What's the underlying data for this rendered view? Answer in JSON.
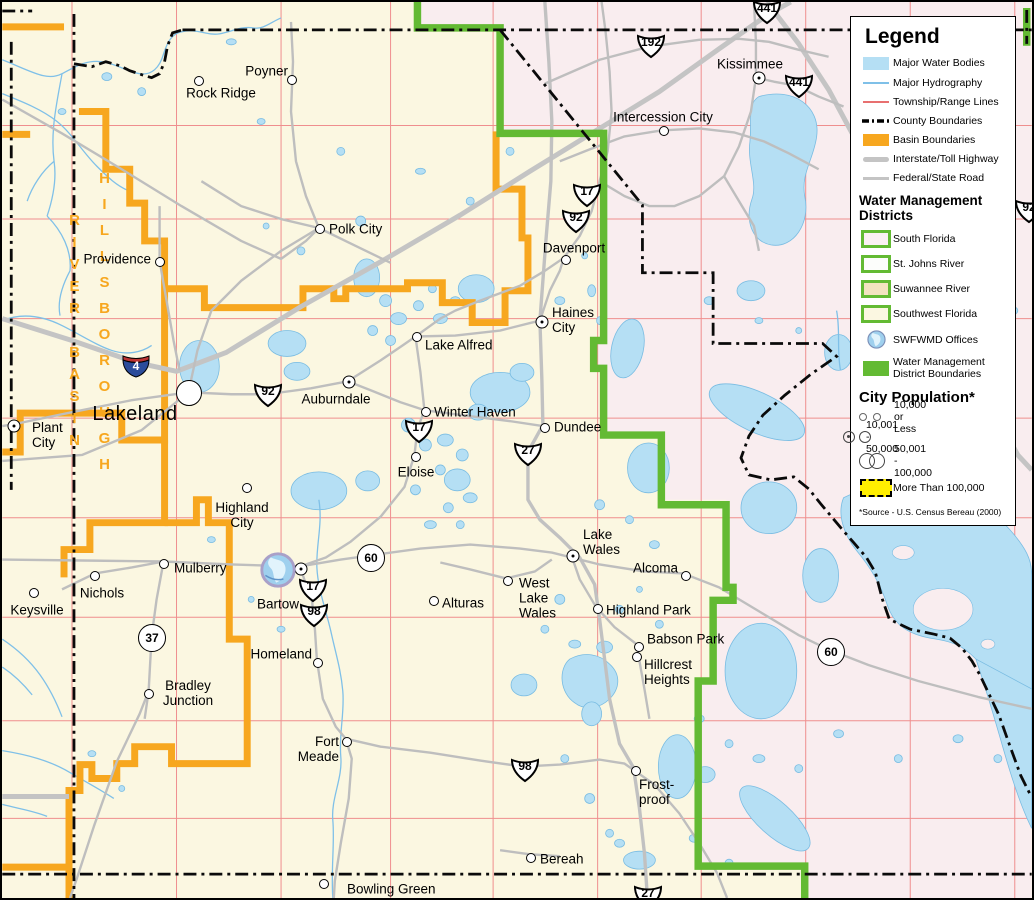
{
  "colors": {
    "background_cream": "#FBF7E1",
    "south_florida_pink": "#F9EDEF",
    "water": "#B5DFF4",
    "hydrography": "#7FC0E8",
    "township_lines": "#EF8E8E",
    "county": "#0A0A0A",
    "basin_orange": "#F7A71F",
    "roads_gray": "#BEBEBE",
    "wmd_green": "#63BA33",
    "lake_label_blue": "#3C6FA5",
    "city_100k_yellow": "#FFEE00"
  },
  "legend": {
    "title": "Legend",
    "items": [
      {
        "label": "Major Water Bodies"
      },
      {
        "label": "Major Hydrography"
      },
      {
        "label": "Township/Range Lines"
      },
      {
        "label": "County Boundaries"
      },
      {
        "label": "Basin Boundaries"
      },
      {
        "label": "Interstate/Toll Highway"
      },
      {
        "label": "Federal/State Road"
      }
    ],
    "wmd_heading": "Water Management\nDistricts",
    "districts": [
      {
        "label": "South Florida",
        "style": "background:#FBF0F3"
      },
      {
        "label": "St. Johns River",
        "style": "background:#FCFDFB"
      },
      {
        "label": "Suwannee River",
        "style": "background:#F3E3C0"
      },
      {
        "label": "Southwest Florida",
        "style": "background:#FBF7E1"
      }
    ],
    "offices_label": "SWFWMD Offices",
    "wmd_boundaries_label": "Water Management\nDistrict Boundaries",
    "pop_heading": "City Population*",
    "pop_items": [
      {
        "label": "10,000 or Less",
        "cls": "pop1"
      },
      {
        "label": "10,001 - 50,000",
        "cls": "pop2"
      },
      {
        "label": "50,001 - 100,000",
        "cls": "pop3"
      }
    ],
    "pop_100k_label": "More Than 100,000",
    "footnote": "*Source - U.S. Census Bereau (2000)"
  },
  "map": {
    "counties": [
      {
        "text": "P O L K",
        "x": 436,
        "y": 524
      },
      {
        "text": "O S C E O L A",
        "x": 845,
        "y": 307
      }
    ],
    "basins": [
      {
        "text": "GREEN",
        "x": 326,
        "y": 127,
        "cls": ""
      },
      {
        "text": "SWAMP",
        "x": 323,
        "y": 154,
        "cls": ""
      },
      {
        "text": "BASIN",
        "x": 325,
        "y": 180,
        "cls": ""
      },
      {
        "text": "GREEN",
        "x": 243,
        "y": 156,
        "cls": "white"
      },
      {
        "text": "SWAMP",
        "x": 242,
        "y": 177,
        "cls": "white"
      },
      {
        "text": "BASIN",
        "x": 241,
        "y": 205,
        "cls": "white"
      },
      {
        "text": "PEACE",
        "x": 424,
        "y": 630,
        "cls": ""
      },
      {
        "text": "RIVER",
        "x": 423,
        "y": 657,
        "cls": ""
      },
      {
        "text": "BASIN",
        "x": 424,
        "y": 684,
        "cls": ""
      },
      {
        "text": "PEACE",
        "x": 437,
        "y": 768,
        "cls": "white"
      },
      {
        "text": "RIVER",
        "x": 437,
        "y": 795,
        "cls": "white"
      },
      {
        "text": "BASIN",
        "x": 437,
        "y": 822,
        "cls": "white"
      },
      {
        "text": "ALAFIA",
        "x": 106,
        "y": 663,
        "cls": ""
      },
      {
        "text": "RIVER",
        "x": 101,
        "y": 689,
        "cls": ""
      },
      {
        "text": "BASIN",
        "x": 104,
        "y": 715,
        "cls": ""
      }
    ],
    "vertical_basins": {
      "hillsborough": "HILLSBOROUGH",
      "river_basin": "RIVER BASIN"
    },
    "cities": [
      {
        "name": "Poyner",
        "x": 290,
        "y": 78,
        "cls": "c-s",
        "lx": 286,
        "ly": 69,
        "a": "a-r"
      },
      {
        "name": "Rock Ridge",
        "x": 197,
        "y": 79,
        "cls": "c-s",
        "lx": 219,
        "ly": 91,
        "a": "a-c"
      },
      {
        "name": "Polk City",
        "x": 318,
        "y": 227,
        "cls": "c-s",
        "lx": 327,
        "ly": 227,
        "a": "a-l"
      },
      {
        "name": "Providence",
        "x": 158,
        "y": 260,
        "cls": "c-s",
        "lx": 149,
        "ly": 257,
        "a": "a-r"
      },
      {
        "name": "Davenport",
        "x": 564,
        "y": 258,
        "cls": "c-s",
        "lx": 572,
        "ly": 246,
        "a": "a-c"
      },
      {
        "name": "Kissimmee",
        "x": 757,
        "y": 76,
        "cls": "c-m",
        "lx": 748,
        "ly": 62,
        "a": "a-c"
      },
      {
        "name": "Intercession City",
        "x": 662,
        "y": 129,
        "cls": "c-s",
        "lx": 661,
        "ly": 115,
        "a": "a-c"
      },
      {
        "name": "Haines\nCity",
        "x": 540,
        "y": 320,
        "cls": "c-m",
        "lx": 550,
        "ly": 318,
        "a": "a-l"
      },
      {
        "name": "Lake Alfred",
        "x": 415,
        "y": 335,
        "cls": "c-s",
        "lx": 423,
        "ly": 343,
        "a": "a-l"
      },
      {
        "name": "Auburndale",
        "x": 347,
        "y": 380,
        "cls": "c-m",
        "lx": 334,
        "ly": 397,
        "a": "a-c"
      },
      {
        "name": "Winter Haven",
        "x": 424,
        "y": 410,
        "cls": "c-s",
        "lx": 432,
        "ly": 410,
        "a": "a-l"
      },
      {
        "name": "Dundee",
        "x": 543,
        "y": 426,
        "cls": "c-s",
        "lx": 552,
        "ly": 425,
        "a": "a-l"
      },
      {
        "name": "Eloise",
        "x": 414,
        "y": 455,
        "cls": "c-s",
        "lx": 414,
        "ly": 470,
        "a": "a-c"
      },
      {
        "name": "Lakeland",
        "x": 187,
        "y": 391,
        "cls": "c-l",
        "lx": 133,
        "ly": 412,
        "a": "a-c",
        "lcls": "big"
      },
      {
        "name": "Plant\nCity",
        "x": 12,
        "y": 424,
        "cls": "c-m",
        "lx": 30,
        "ly": 433,
        "a": "a-l"
      },
      {
        "name": "Highland\nCity",
        "x": 245,
        "y": 486,
        "cls": "c-s",
        "lx": 240,
        "ly": 513,
        "a": "a-c"
      },
      {
        "name": "Mulberry",
        "x": 162,
        "y": 562,
        "cls": "c-s",
        "lx": 172,
        "ly": 566,
        "a": "a-l"
      },
      {
        "name": "Nichols",
        "x": 93,
        "y": 574,
        "cls": "c-s",
        "lx": 100,
        "ly": 591,
        "a": "a-c"
      },
      {
        "name": "Keysville",
        "x": 32,
        "y": 591,
        "cls": "c-s",
        "lx": 35,
        "ly": 608,
        "a": "a-c"
      },
      {
        "name": "Bartow",
        "x": 299,
        "y": 567,
        "cls": "c-m",
        "lx": 276,
        "ly": 602,
        "a": "a-c"
      },
      {
        "name": "Homeland",
        "x": 316,
        "y": 661,
        "cls": "c-s",
        "lx": 310,
        "ly": 652,
        "a": "a-r"
      },
      {
        "name": "Bradley\nJunction",
        "x": 147,
        "y": 692,
        "cls": "c-s",
        "lx": 186,
        "ly": 691,
        "a": "a-c"
      },
      {
        "name": "Fort\nMeade",
        "x": 345,
        "y": 740,
        "cls": "c-s",
        "lx": 337,
        "ly": 747,
        "a": "a-r"
      },
      {
        "name": "Bowling Green",
        "x": 322,
        "y": 882,
        "cls": "c-s",
        "lx": 345,
        "ly": 887,
        "a": "a-l"
      },
      {
        "name": "Bereah",
        "x": 529,
        "y": 856,
        "cls": "c-s",
        "lx": 538,
        "ly": 857,
        "a": "a-l"
      },
      {
        "name": "Frost-\nproof",
        "x": 634,
        "y": 769,
        "cls": "c-s",
        "lx": 637,
        "ly": 790,
        "a": "a-l"
      },
      {
        "name": "Lake\nWales",
        "x": 571,
        "y": 554,
        "cls": "c-m",
        "lx": 581,
        "ly": 540,
        "a": "a-l"
      },
      {
        "name": "West\nLake\nWales",
        "x": 506,
        "y": 579,
        "cls": "c-s",
        "lx": 517,
        "ly": 596,
        "a": "a-l"
      },
      {
        "name": "Alcoma",
        "x": 684,
        "y": 574,
        "cls": "c-s",
        "lx": 676,
        "ly": 566,
        "a": "a-r"
      },
      {
        "name": "Highland Park",
        "x": 596,
        "y": 607,
        "cls": "c-s",
        "lx": 604,
        "ly": 608,
        "a": "a-l"
      },
      {
        "name": "Babson Park",
        "x": 637,
        "y": 645,
        "cls": "c-s",
        "lx": 645,
        "ly": 637,
        "a": "a-l"
      },
      {
        "name": "Hillcrest\nHeights",
        "x": 635,
        "y": 655,
        "cls": "c-s",
        "lx": 642,
        "ly": 670,
        "a": "a-l"
      },
      {
        "name": "Alturas",
        "x": 432,
        "y": 599,
        "cls": "c-s",
        "lx": 440,
        "ly": 601,
        "a": "a-l"
      }
    ],
    "partial_labels": [
      {
        "name": "ls",
        "x": 2,
        "y": 160,
        "a": "a-l"
      },
      {
        "name": "Lonesome",
        "x": 3,
        "y": 789,
        "a": "a-l"
      }
    ],
    "lakes": [
      {
        "text": "Withlacoochee",
        "x": 105,
        "y": 55,
        "rot": 8,
        "cls": "md"
      },
      {
        "text": "River",
        "x": 218,
        "y": 40,
        "rot": -18,
        "cls": "md"
      },
      {
        "text": "kwater",
        "x": 14,
        "y": 272,
        "rot": 15,
        "cls": "sm"
      },
      {
        "text": "Creek",
        "x": 48,
        "y": 287,
        "rot": 35,
        "cls": "sm"
      },
      {
        "text": "Itchepackesassa",
        "x": 42,
        "y": 328,
        "rot": 38,
        "cls": "sm"
      },
      {
        "text": "Prong",
        "x": 22,
        "y": 748,
        "rot": 18,
        "cls": "sm"
      },
      {
        "text": "Prong",
        "x": 48,
        "y": 561,
        "rot": -30,
        "cls": "sm"
      },
      {
        "text": "South",
        "x": 8,
        "y": 655,
        "rot": 68,
        "cls": "sm"
      },
      {
        "text": "Peace",
        "x": 330,
        "y": 850,
        "rot": 75,
        "cls": "sm"
      },
      {
        "text": "River",
        "x": 348,
        "y": 680,
        "rot": 80,
        "cls": "sm"
      },
      {
        "text": "Lake\nMattie",
        "x": 392,
        "y": 273,
        "rot": 0,
        "cls": ""
      },
      {
        "text": "Lake\nLowery",
        "x": 476,
        "y": 258,
        "rot": 0,
        "cls": ""
      },
      {
        "text": "Lake\nArietta",
        "x": 312,
        "y": 322,
        "rot": 0,
        "cls": ""
      },
      {
        "text": "Lake Ariana",
        "x": 303,
        "y": 355,
        "rot": 0,
        "cls": ""
      },
      {
        "text": "Lake\nParker",
        "x": 206,
        "y": 360,
        "rot": 0,
        "cls": ""
      },
      {
        "text": "Lake\nHamilton",
        "x": 500,
        "y": 378,
        "rot": 0,
        "cls": ""
      },
      {
        "text": "Eagle\nLake",
        "x": 355,
        "y": 467,
        "rot": 0,
        "cls": ""
      },
      {
        "text": "Lake\nEloise",
        "x": 447,
        "y": 466,
        "rot": 0,
        "cls": ""
      },
      {
        "text": "Lake\nHancock",
        "x": 305,
        "y": 477,
        "rot": 0,
        "cls": ""
      },
      {
        "text": "Lake Marion",
        "x": 624,
        "y": 345,
        "rot": 68,
        "cls": ""
      },
      {
        "text": "Lake\nRussell",
        "x": 736,
        "y": 289,
        "rot": 0,
        "cls": ""
      },
      {
        "text": "Lake Tohopekaliga",
        "x": 792,
        "y": 200,
        "rot": 62,
        "cls": "md"
      },
      {
        "text": "Lake Hatchineha",
        "x": 755,
        "y": 410,
        "rot": 33,
        "cls": "md"
      },
      {
        "text": "Lake  Kissimmee",
        "x": 912,
        "y": 548,
        "rot": 44,
        "cls": "lg"
      },
      {
        "text": "Lake\nRosalie",
        "x": 768,
        "y": 529,
        "rot": 0,
        "cls": ""
      },
      {
        "text": "Tiger\nLake",
        "x": 815,
        "y": 572,
        "rot": 0,
        "cls": ""
      },
      {
        "text": "Lake\nWeohyakapka",
        "x": 760,
        "y": 656,
        "rot": 0,
        "cls": ""
      },
      {
        "text": "Crooked\nLake",
        "x": 584,
        "y": 671,
        "rot": 0,
        "cls": ""
      },
      {
        "text": "Lake\nBuffum",
        "x": 494,
        "y": 688,
        "rot": 0,
        "cls": ""
      },
      {
        "text": "Lake\nClinch",
        "x": 612,
        "y": 757,
        "rot": 0,
        "cls": ""
      },
      {
        "text": "Reedy Lake",
        "x": 668,
        "y": 762,
        "rot": 0,
        "cls": ""
      },
      {
        "text": "Lake Livingston",
        "x": 652,
        "y": 846,
        "rot": 0,
        "cls": ""
      },
      {
        "text": "Lake Arbuckle",
        "x": 776,
        "y": 818,
        "rot": 48,
        "cls": "md"
      },
      {
        "text": "Lake\nPierce",
        "x": 646,
        "y": 475,
        "rot": 0,
        "cls": ""
      }
    ],
    "shields_us": [
      {
        "num": "441",
        "x": 765,
        "y": 10
      },
      {
        "num": "441",
        "x": 797,
        "y": 84
      },
      {
        "num": "192",
        "x": 649,
        "y": 44
      },
      {
        "num": "17",
        "x": 585,
        "y": 193
      },
      {
        "num": "92",
        "x": 574,
        "y": 219
      },
      {
        "num": "92",
        "x": 266,
        "y": 393
      },
      {
        "num": "17",
        "x": 417,
        "y": 429
      },
      {
        "num": "27",
        "x": 526,
        "y": 452
      },
      {
        "num": "17",
        "x": 311,
        "y": 588
      },
      {
        "num": "98",
        "x": 312,
        "y": 613
      },
      {
        "num": "98",
        "x": 523,
        "y": 768
      },
      {
        "num": "27",
        "x": 646,
        "y": 895
      },
      {
        "num": "92",
        "x": 1027,
        "y": 209
      }
    ],
    "shields_circle": [
      {
        "num": "60",
        "x": 369,
        "y": 556
      },
      {
        "num": "60",
        "x": 829,
        "y": 650
      },
      {
        "num": "37",
        "x": 150,
        "y": 636
      }
    ],
    "shields_int": [
      {
        "num": "4",
        "x": 134,
        "y": 364
      }
    ],
    "offices": [
      {
        "x": 276,
        "y": 568,
        "w": 36
      }
    ]
  }
}
